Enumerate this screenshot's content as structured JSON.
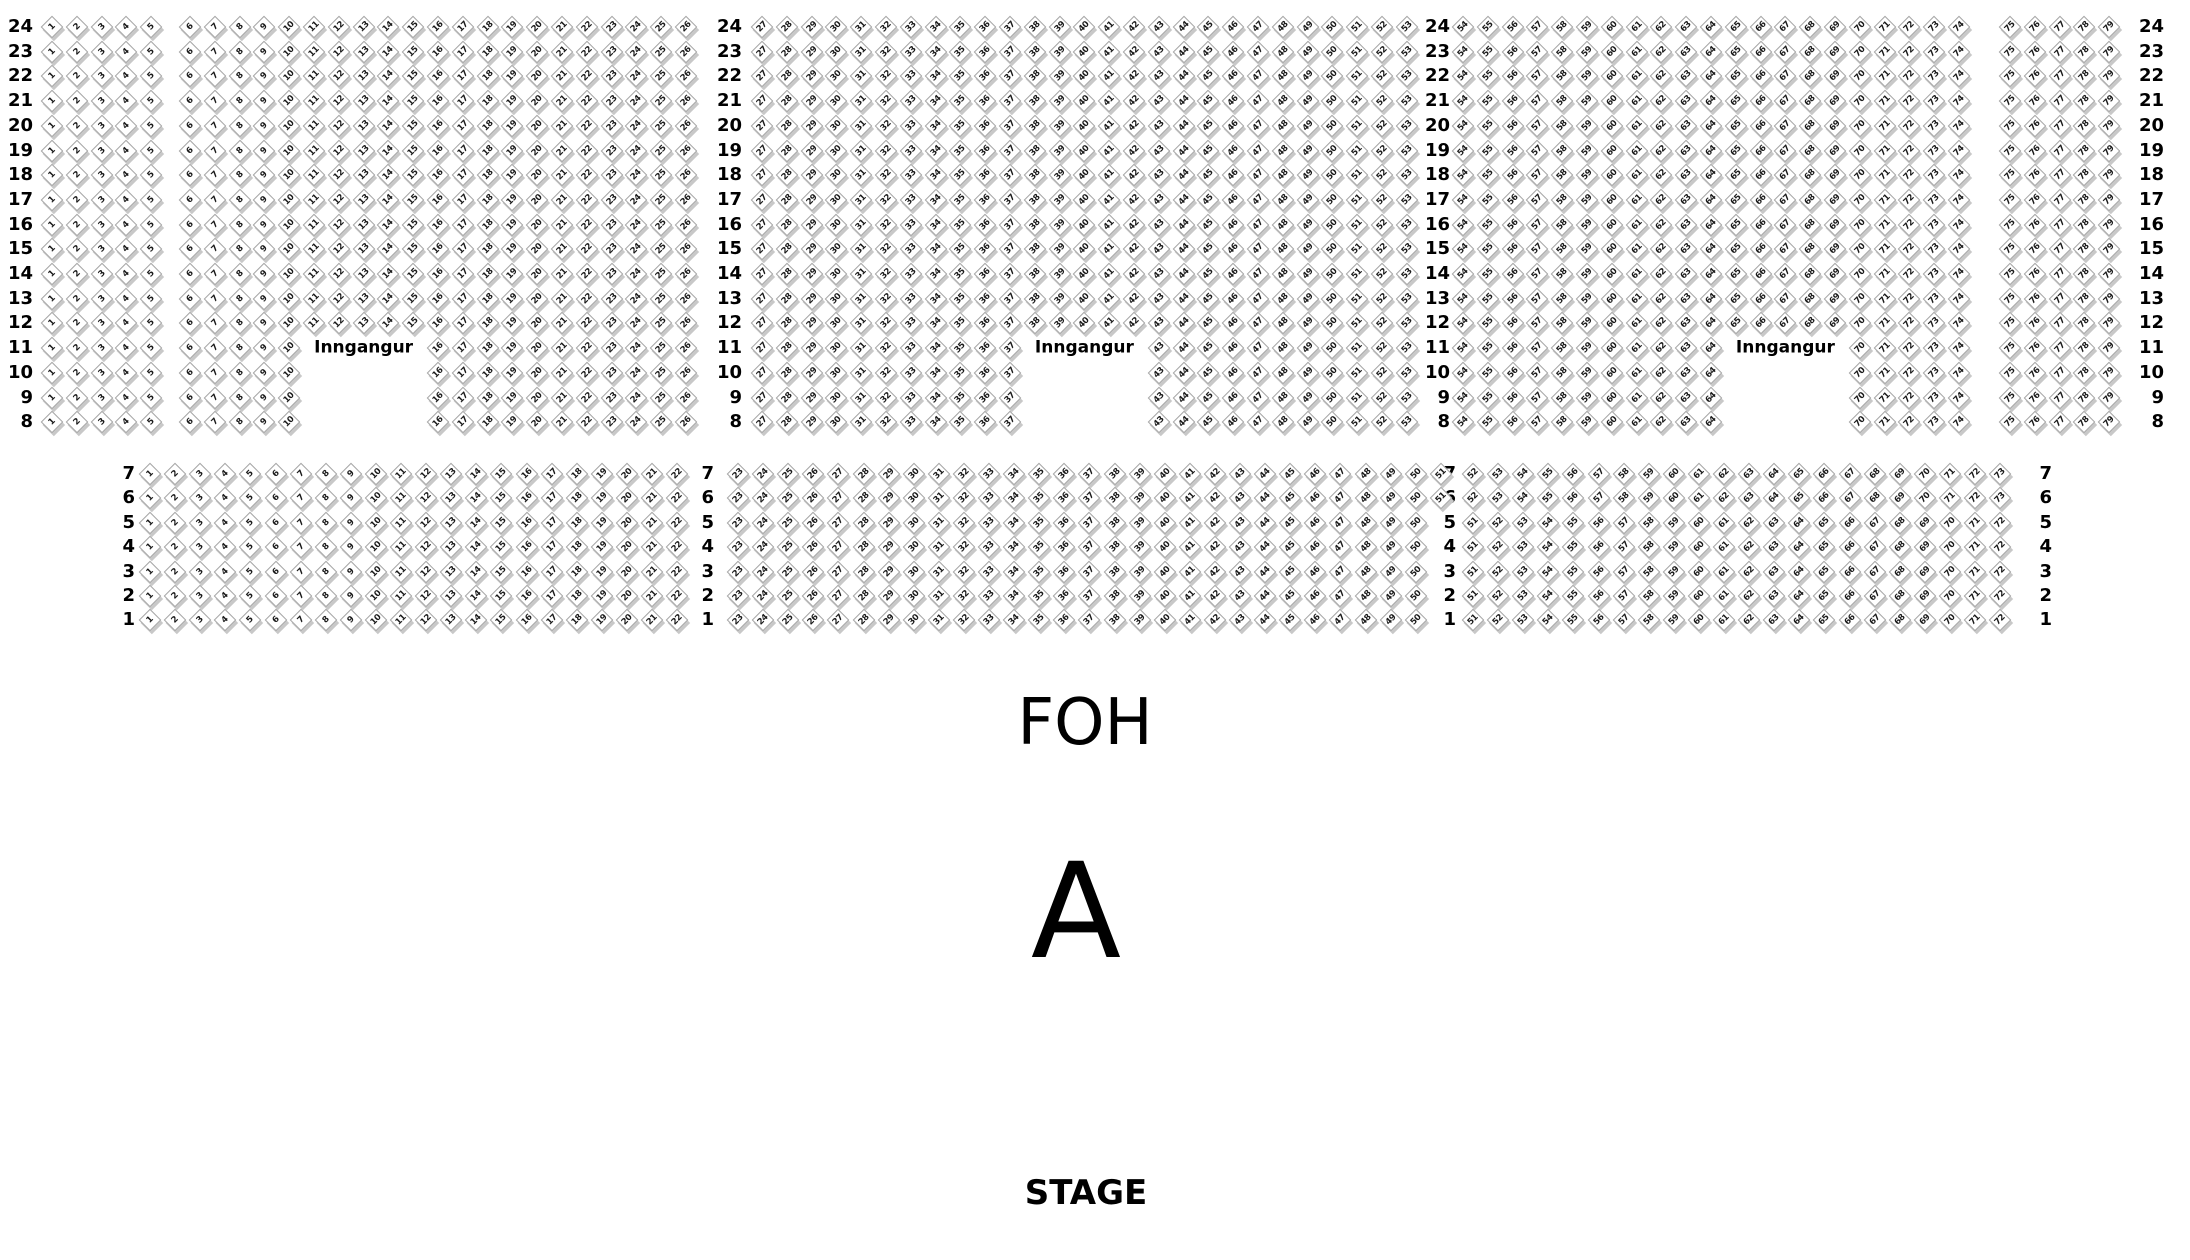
{
  "venue_map": {
    "foh_label": "FOH",
    "section_letter": "A",
    "stage_label": "STAGE",
    "entrance_label": "Inngangur",
    "colors": {
      "background": "#ffffff",
      "seat_face": "#ffffff",
      "seat_border": "#a6a6a6",
      "seat_shadow": "#c8c8c8",
      "text": "#000000"
    },
    "top_block": {
      "row_numbers": [
        24,
        23,
        22,
        21,
        20,
        19,
        18,
        17,
        16,
        15,
        14,
        13,
        12,
        11,
        10,
        9,
        8
      ],
      "entrance_rows": [
        11,
        10,
        9,
        8
      ],
      "entrance_label_row": 11,
      "groups": [
        {
          "name": "left-wing",
          "first_seat": 1,
          "last_seat": 5,
          "entrance_gap_seats": null
        },
        {
          "name": "left-main",
          "first_seat": 6,
          "last_seat": 26,
          "entrance_gap_seats": [
            11,
            15
          ]
        },
        {
          "name": "center-main",
          "first_seat": 27,
          "last_seat": 53,
          "entrance_gap_seats": [
            38,
            42
          ]
        },
        {
          "name": "right-main",
          "first_seat": 54,
          "last_seat": 74,
          "entrance_gap_seats": [
            65,
            69
          ]
        },
        {
          "name": "right-wing",
          "first_seat": 75,
          "last_seat": 79,
          "entrance_gap_seats": null
        }
      ]
    },
    "bottom_block": {
      "row_numbers": [
        7,
        6,
        5,
        4,
        3,
        2,
        1
      ],
      "sections": [
        {
          "name": "left",
          "first_seat": 1,
          "last_seat": 22
        },
        {
          "name": "center",
          "first_seat": 23,
          "last_seats": {
            "7": 51,
            "6": 51,
            "5": 50,
            "4": 50,
            "3": 50,
            "2": 50,
            "1": 50
          }
        },
        {
          "name": "right",
          "seat_count": 22,
          "first_seats": {
            "7": 52,
            "6": 52,
            "5": 51,
            "4": 51,
            "3": 51,
            "2": 51,
            "1": 51
          },
          "last_seats": {
            "7": 73,
            "6": 73,
            "5": 72,
            "4": 72,
            "3": 72,
            "2": 72,
            "1": 72
          }
        }
      ]
    }
  }
}
